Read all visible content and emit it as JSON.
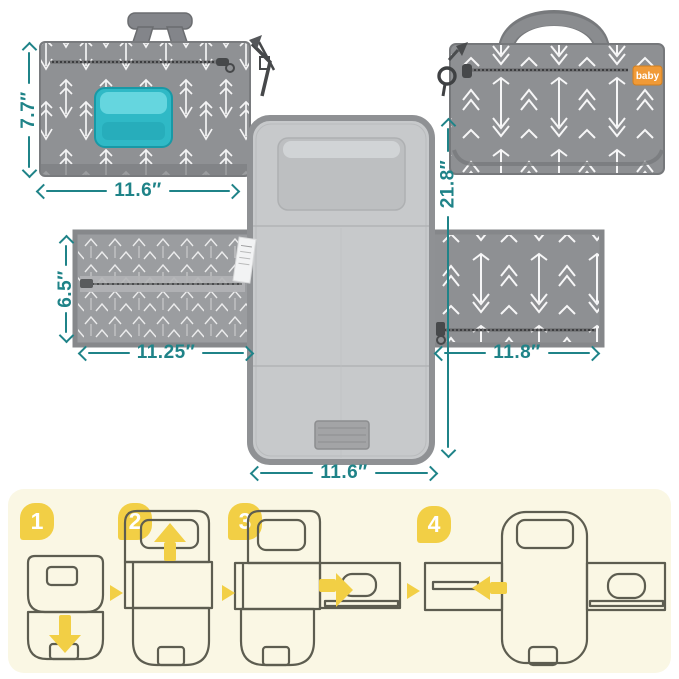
{
  "product": {
    "views": {
      "front": {
        "height_label": "7.7″",
        "width_label": "11.6″"
      },
      "back": {
        "logo": "baby",
        "unfolded_length_label": "21.8″"
      },
      "open": {
        "left_pocket_height_label": "6.5″",
        "left_pocket_width_label": "11.25″",
        "right_pocket_width_label": "11.8″",
        "mat_width_label": "11.6″"
      }
    }
  },
  "steps": {
    "items": [
      {
        "number": "1"
      },
      {
        "number": "2"
      },
      {
        "number": "3"
      },
      {
        "number": "4"
      }
    ]
  },
  "colors": {
    "dimension_teal": "#1f8388",
    "accent_yellow": "#f2cf45",
    "panel_cream": "#faf7e4",
    "step_outline": "#5d5d50",
    "fabric_gray": "#8e9093",
    "pad_gray": "#c7c9cb",
    "wipes_teal": "#3ec6d0",
    "logo_orange": "#f09a37",
    "background": "#ffffff"
  }
}
